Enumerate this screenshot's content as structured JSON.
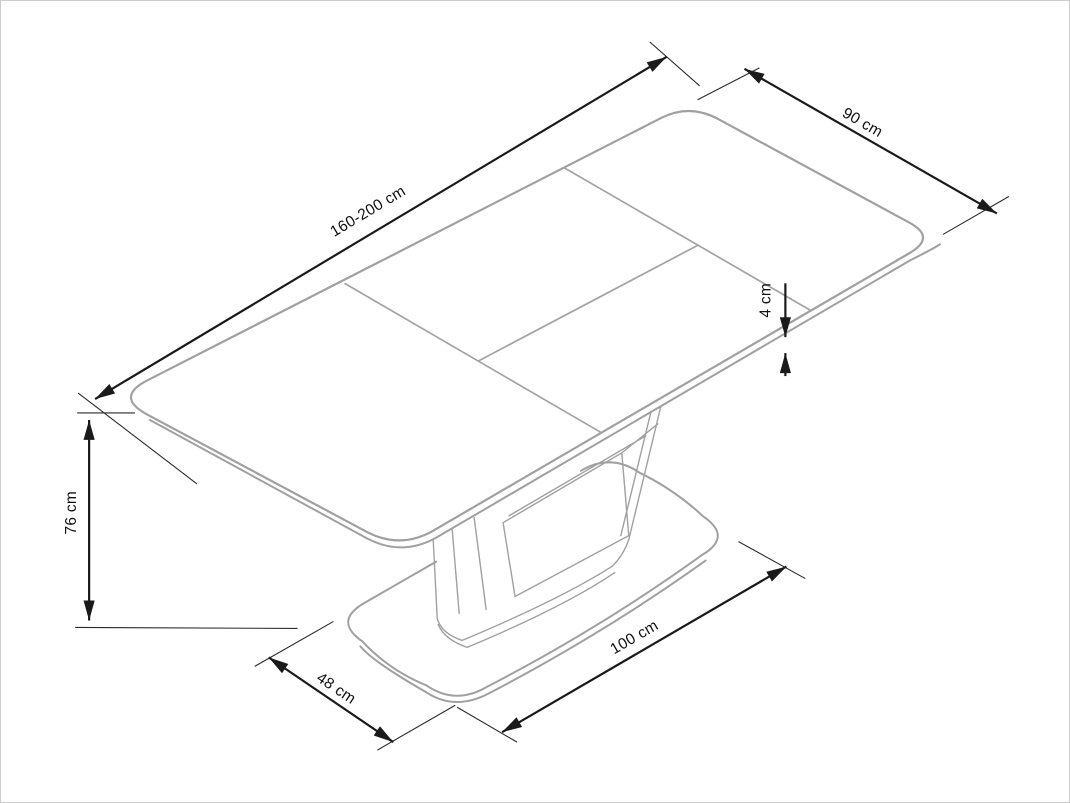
{
  "diagram": {
    "type": "furniture-dimension-drawing",
    "subject": "extendable pedestal dining table - technical dimension diagram",
    "background_color": "#ffffff",
    "colors": {
      "furniture_outline": "#a0a0a0",
      "dimension_lines": "#1a1a1a",
      "canvas_border": "#cccccc"
    },
    "dimensions": {
      "table_length": {
        "label": "160-200 cm"
      },
      "table_width": {
        "label": "90 cm"
      },
      "top_thickness": {
        "label": "4 cm"
      },
      "table_height": {
        "label": "76 cm"
      },
      "base_length": {
        "label": "100 cm"
      },
      "base_width": {
        "label": "48 cm"
      }
    }
  }
}
